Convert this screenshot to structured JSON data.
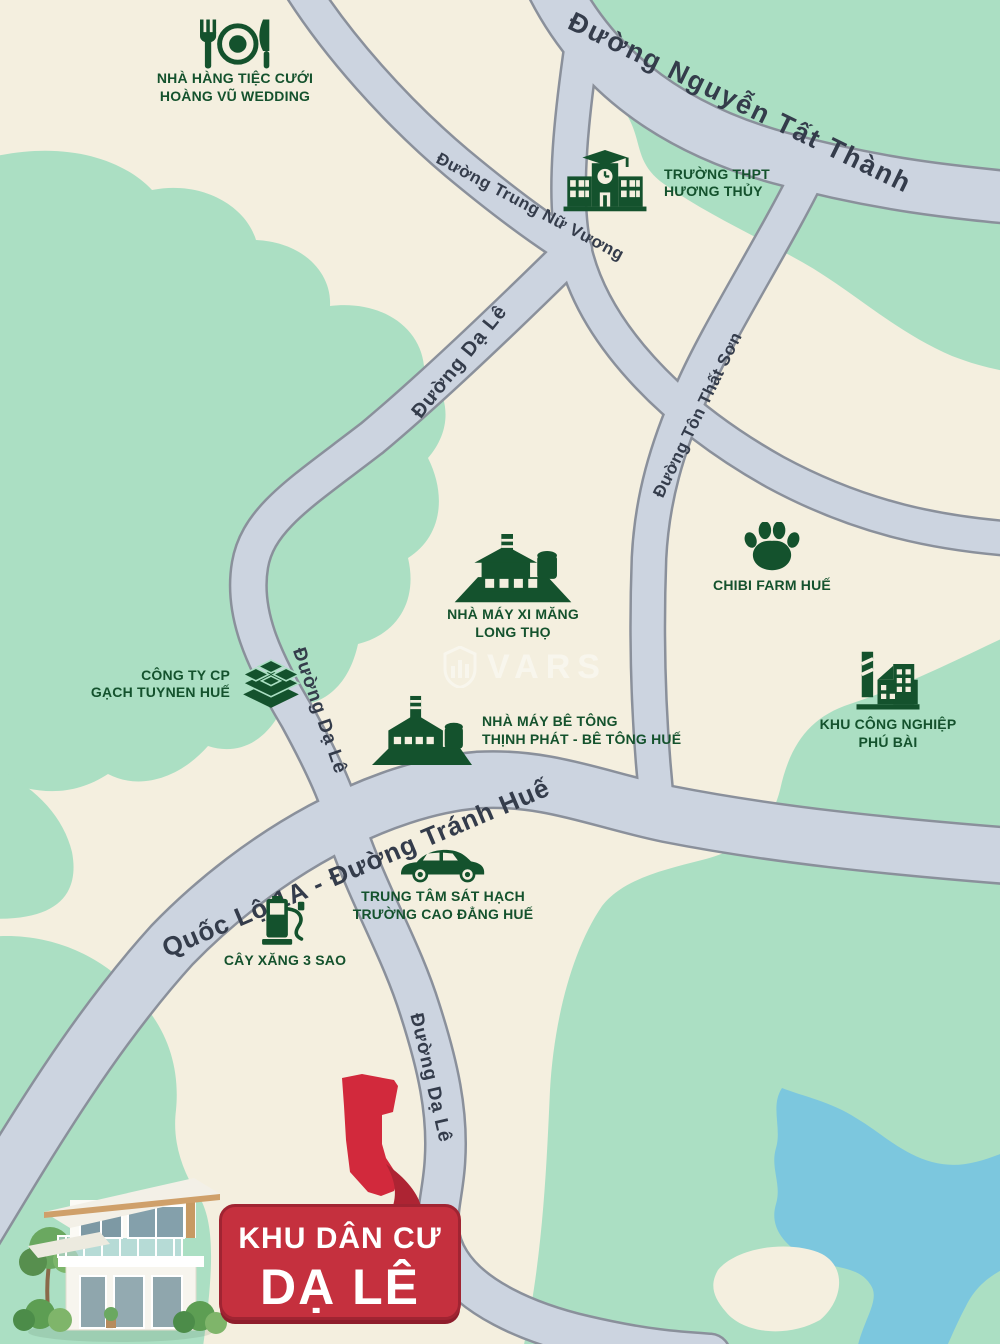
{
  "map": {
    "badge": {
      "line1": "KHU DÂN CƯ",
      "line2": "DẠ LÊ"
    },
    "watermark": {
      "brand": "VARS"
    },
    "roads": [
      {
        "name": "nguyen-tat-thanh",
        "label": "Đường Nguyễn Tất Thành"
      },
      {
        "name": "trung-nu-vuong",
        "label": "Đường Trung Nữ Vương"
      },
      {
        "name": "da-le-upper",
        "label": "Đường Dạ Lê"
      },
      {
        "name": "ton-that-son",
        "label": "Đường Tôn Thất Sơn"
      },
      {
        "name": "da-le-mid",
        "label": "Đường Dạ Lê"
      },
      {
        "name": "quoc-lo-1a",
        "label": "Quốc Lộ 1A - Đường Tránh Huế"
      },
      {
        "name": "da-le-bottom",
        "label": "Đường Dạ Lê"
      }
    ],
    "pois": [
      {
        "name": "hoang-vu-wedding",
        "icon": "restaurant-icon",
        "lines": [
          "NHÀ HÀNG TIỆC CƯỚI",
          "HOÀNG VŨ WEDDING"
        ]
      },
      {
        "name": "thpt-huong-thuy",
        "icon": "school-icon",
        "lines": [
          "TRƯỜNG THPT",
          "HƯƠNG THỦY"
        ]
      },
      {
        "name": "xi-mang-long-tho",
        "icon": "factory-icon",
        "lines": [
          "NHÀ MÁY XI MĂNG",
          "LONG THỌ"
        ]
      },
      {
        "name": "chibi-farm-hue",
        "icon": "paw-icon",
        "lines": [
          "CHIBI FARM HUẾ"
        ]
      },
      {
        "name": "gach-tuynen-hue",
        "icon": "bricks-icon",
        "lines": [
          "CÔNG TY CP",
          "GẠCH TUYNEN HUẾ"
        ]
      },
      {
        "name": "be-tong-thinh-phat",
        "icon": "factory-icon",
        "lines": [
          "NHÀ MÁY BÊ TÔNG",
          "THỊNH PHÁT - BÊ TÔNG HUẾ"
        ]
      },
      {
        "name": "kcn-phu-bai",
        "icon": "industrial-icon",
        "lines": [
          "KHU CÔNG NGHIỆP",
          "PHÚ BÀI"
        ]
      },
      {
        "name": "trung-tam-sat-hach",
        "icon": "car-icon",
        "lines": [
          "TRUNG TÂM SÁT HẠCH",
          "TRƯỜNG CAO ĐẲNG HUẾ"
        ]
      },
      {
        "name": "cay-xang-3-sao",
        "icon": "gas-pump-icon",
        "lines": [
          "CÂY XĂNG 3 SAO"
        ]
      }
    ],
    "colors": {
      "land": "#f4efdf",
      "vegetation": "#abdfc3",
      "water": "#7cc7de",
      "road_fill": "#ccd4e0",
      "road_edge": "#8a909b",
      "poi_green": "#14522d",
      "road_text": "#343c4b",
      "project_red": "#d2293c",
      "badge_red": "#c5303e",
      "badge_border": "#a02432"
    }
  }
}
